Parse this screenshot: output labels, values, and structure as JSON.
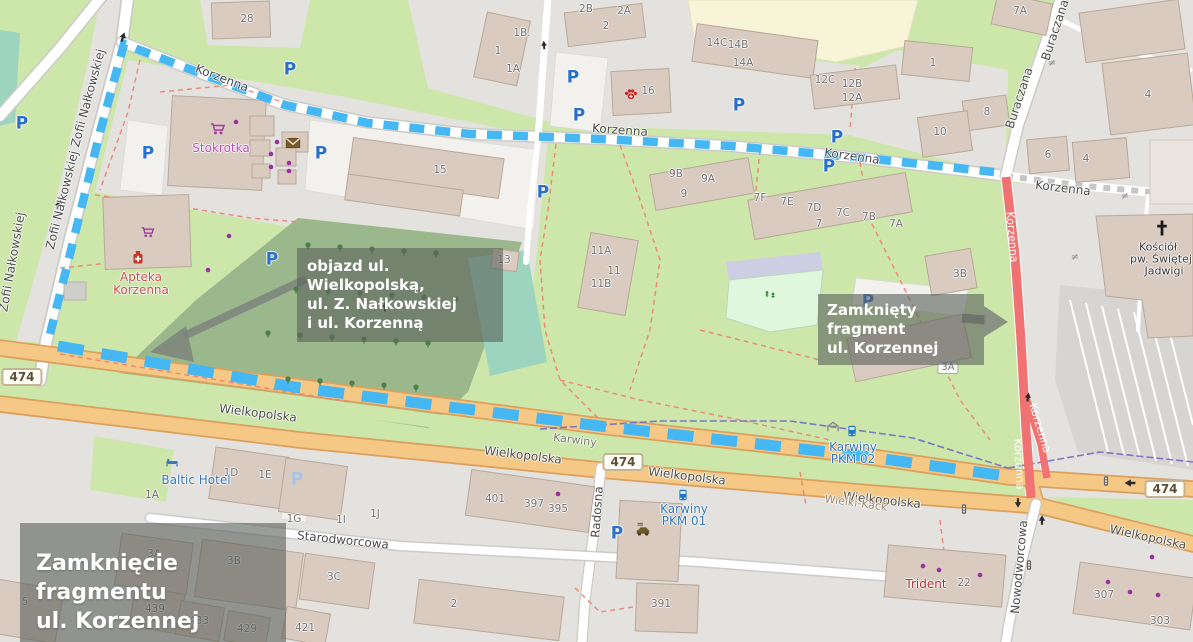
{
  "map": {
    "overlays": {
      "title": {
        "line1": "Zamknięcie fragmentu",
        "line2": "ul. Korzennej"
      },
      "detour_note": {
        "line1": "objazd ul. Wielkopolską,",
        "line2": "ul. Z. Nałkowskiej",
        "line3": "i ul. Korzenną"
      },
      "closure_note": {
        "line1": "Zamknięty fragment",
        "line2": "ul. Korzennej"
      }
    },
    "colors": {
      "route_blue": "#45b7f2",
      "closure_red": "#f17272",
      "road_orange": "#f6c885",
      "road_orange_casing": "#dba05c",
      "green": "#cde7ab",
      "residential_gray": "#e4e2df",
      "cemetery_green": "#9ab88c",
      "teal_pitch": "#9dd4bf",
      "school_yellow": "#f7f4d8",
      "building_fill": "#d9cbc0",
      "building_stroke": "#b9a896",
      "boundary_purple": "#6f63c8",
      "path_red": "#ee8273",
      "note_box_bg": "rgba(92,99,92,0.62)"
    },
    "label_groups": [
      {
        "name": "street-label",
        "cls": "lbl-street halo",
        "items": [
          {
            "t": "Zofii Nałkowskiej",
            "x": 88,
            "y": 98,
            "r": -75
          },
          {
            "t": "Zofii Nałkowskiej",
            "x": 62,
            "y": 200,
            "r": -76
          },
          {
            "t": "Zofii Nałkowskiej",
            "x": 12,
            "y": 262,
            "r": -80
          },
          {
            "t": "Korzenna",
            "x": 222,
            "y": 78,
            "r": 21
          },
          {
            "t": "Korzenna",
            "x": 620,
            "y": 130,
            "r": 4
          },
          {
            "t": "Korzenna",
            "x": 852,
            "y": 156,
            "r": 8
          },
          {
            "t": "Korzenna",
            "x": 1063,
            "y": 188,
            "r": 7
          },
          {
            "t": "Buraczana",
            "x": 1055,
            "y": 30,
            "r": -72
          },
          {
            "t": "Buraczana",
            "x": 1019,
            "y": 98,
            "r": -72
          },
          {
            "t": "Wielkopolska",
            "x": 258,
            "y": 413,
            "r": 7
          },
          {
            "t": "Wielkopolska",
            "x": 523,
            "y": 455,
            "r": 7
          },
          {
            "t": "Wielkopolska",
            "x": 687,
            "y": 476,
            "r": 7
          },
          {
            "t": "Wielkopolska",
            "x": 882,
            "y": 500,
            "r": 6
          },
          {
            "t": "Wielkopolska",
            "x": 1148,
            "y": 537,
            "r": 12
          },
          {
            "t": "Starodworcowa",
            "x": 343,
            "y": 540,
            "r": 6
          },
          {
            "t": "Radosna",
            "x": 597,
            "y": 512,
            "r": -86
          },
          {
            "t": "Nowodworcowa",
            "x": 1019,
            "y": 567,
            "r": -85
          }
        ]
      },
      {
        "name": "street-label-closed-road",
        "cls": "lbl-onred",
        "items": [
          {
            "t": "Korzenna",
            "x": 1012,
            "y": 237,
            "r": 85
          },
          {
            "t": "Korzenna",
            "x": 1040,
            "y": 428,
            "r": 73
          },
          {
            "t": "Korzenna",
            "x": 1019,
            "y": 464,
            "r": 87
          }
        ]
      },
      {
        "name": "district-label",
        "cls": "lbl-district halo",
        "items": [
          {
            "t": "Karwiny",
            "x": 575,
            "y": 440,
            "r": 7
          }
        ]
      },
      {
        "name": "locality-label",
        "cls": "lbl-hamlet halo",
        "items": [
          {
            "t": "Wielki-Kack",
            "x": 856,
            "y": 503,
            "r": 8
          }
        ]
      },
      {
        "name": "house-number",
        "cls": "lbl-num halo",
        "items": [
          {
            "t": "28",
            "x": 247,
            "y": 19
          },
          {
            "t": "1B.",
            "x": 522,
            "y": 33
          },
          {
            "t": "1",
            "x": 498,
            "y": 51
          },
          {
            "t": "1A",
            "x": 513,
            "y": 69
          },
          {
            "t": "2B",
            "x": 586,
            "y": 9
          },
          {
            "t": "2A",
            "x": 624,
            "y": 11
          },
          {
            "t": "2",
            "x": 606,
            "y": 26
          },
          {
            "t": "14C",
            "x": 717,
            "y": 43
          },
          {
            "t": "14B",
            "x": 738,
            "y": 45
          },
          {
            "t": "14A",
            "x": 743,
            "y": 63
          },
          {
            "t": "16",
            "x": 648,
            "y": 91
          },
          {
            "t": "12C",
            "x": 825,
            "y": 80
          },
          {
            "t": "12B",
            "x": 852,
            "y": 84
          },
          {
            "t": "12A",
            "x": 852,
            "y": 98
          },
          {
            "t": "1",
            "x": 933,
            "y": 63
          },
          {
            "t": "8",
            "x": 987,
            "y": 112
          },
          {
            "t": "10",
            "x": 940,
            "y": 132
          },
          {
            "t": "7A",
            "x": 1020,
            "y": 11
          },
          {
            "t": "6",
            "x": 1048,
            "y": 155
          },
          {
            "t": "4",
            "x": 1086,
            "y": 159
          },
          {
            "t": "4",
            "x": 1148,
            "y": 95
          },
          {
            "t": "15",
            "x": 440,
            "y": 170
          },
          {
            "t": "9B",
            "x": 676,
            "y": 174
          },
          {
            "t": "9A",
            "x": 708,
            "y": 179
          },
          {
            "t": "9",
            "x": 684,
            "y": 194
          },
          {
            "t": "7F",
            "x": 760,
            "y": 198
          },
          {
            "t": "7E",
            "x": 787,
            "y": 202
          },
          {
            "t": "7D",
            "x": 814,
            "y": 208
          },
          {
            "t": "7C",
            "x": 843,
            "y": 213
          },
          {
            "t": "7B",
            "x": 869,
            "y": 217
          },
          {
            "t": "7A",
            "x": 896,
            "y": 224
          },
          {
            "t": "7",
            "x": 819,
            "y": 224
          },
          {
            "t": "11A",
            "x": 601,
            "y": 251
          },
          {
            "t": "11",
            "x": 614,
            "y": 271
          },
          {
            "t": "11B",
            "x": 601,
            "y": 284
          },
          {
            "t": "13",
            "x": 504,
            "y": 260
          },
          {
            "t": "3B",
            "x": 960,
            "y": 274
          },
          {
            "t": "5",
            "x": 878,
            "y": 350
          },
          {
            "t": "1A",
            "x": 152,
            "y": 495
          },
          {
            "t": "1D",
            "x": 231,
            "y": 473
          },
          {
            "t": "1E",
            "x": 265,
            "y": 475
          },
          {
            "t": "1G",
            "x": 294,
            "y": 519
          },
          {
            "t": "1I",
            "x": 341,
            "y": 520
          },
          {
            "t": "1J",
            "x": 375,
            "y": 514
          },
          {
            "t": "401",
            "x": 495,
            "y": 499
          },
          {
            "t": "397",
            "x": 534,
            "y": 504
          },
          {
            "t": "395",
            "x": 558,
            "y": 509
          },
          {
            "t": "3A",
            "x": 154,
            "y": 554
          },
          {
            "t": "3B",
            "x": 234,
            "y": 561
          },
          {
            "t": "3C",
            "x": 334,
            "y": 577
          },
          {
            "t": "5",
            "x": 25,
            "y": 602
          },
          {
            "t": "439",
            "x": 155,
            "y": 609
          },
          {
            "t": "433",
            "x": 199,
            "y": 621
          },
          {
            "t": "429",
            "x": 247,
            "y": 629
          },
          {
            "t": "421",
            "x": 305,
            "y": 628
          },
          {
            "t": "2",
            "x": 454,
            "y": 604
          },
          {
            "t": "391",
            "x": 661,
            "y": 604
          },
          {
            "t": "22",
            "x": 964,
            "y": 583
          },
          {
            "t": "307",
            "x": 1104,
            "y": 595
          },
          {
            "t": "303",
            "x": 1160,
            "y": 621
          }
        ]
      },
      {
        "name": "poi-label-supermarket",
        "cls": "poi-shop halo",
        "items": [
          {
            "t": "Stokrotka",
            "x": 221,
            "y": 148
          }
        ]
      },
      {
        "name": "poi-label-pharmacy",
        "cls": "poi-red halo",
        "items": [
          {
            "t": "Apteka",
            "x": 141,
            "y": 277
          },
          {
            "t": "Korzenna",
            "x": 141,
            "y": 290
          }
        ]
      },
      {
        "name": "poi-label-hotel",
        "cls": "poi-blue halo",
        "items": [
          {
            "t": "Baltic Hotel",
            "x": 196,
            "y": 480
          }
        ]
      },
      {
        "name": "poi-label-transit-stop",
        "cls": "poi-blue halo",
        "items": [
          {
            "t": "Karwiny",
            "x": 853,
            "y": 447
          },
          {
            "t": "PKM 02",
            "x": 853,
            "y": 459
          },
          {
            "t": "Karwiny",
            "x": 684,
            "y": 509
          },
          {
            "t": "PKM 01",
            "x": 684,
            "y": 521
          }
        ]
      },
      {
        "name": "poi-label-church",
        "cls": "poi-dark halo",
        "items": [
          {
            "t": "Kościół",
            "x": 1158,
            "y": 247
          },
          {
            "t": "pw. Świętej",
            "x": 1161,
            "y": 259
          },
          {
            "t": "Jadwigi",
            "x": 1164,
            "y": 271
          }
        ]
      },
      {
        "name": "poi-label-business",
        "cls": "poi-red2 halo",
        "items": [
          {
            "t": "Trident",
            "x": 926,
            "y": 584
          }
        ]
      },
      {
        "name": "parking-icon",
        "cls": "lbl-p halo",
        "t": "P",
        "items": [
          {
            "x": 22,
            "y": 124
          },
          {
            "x": 148,
            "y": 154
          },
          {
            "x": 290,
            "y": 70
          },
          {
            "x": 321,
            "y": 154
          },
          {
            "x": 272,
            "y": 260
          },
          {
            "x": 573,
            "y": 78
          },
          {
            "x": 579,
            "y": 116
          },
          {
            "x": 543,
            "y": 193
          },
          {
            "x": 739,
            "y": 106
          },
          {
            "x": 837,
            "y": 138
          },
          {
            "x": 829,
            "y": 167
          },
          {
            "x": 868,
            "y": 302
          },
          {
            "x": 617,
            "y": 534
          }
        ]
      },
      {
        "name": "parking-garage-icon",
        "cls": "lbl-p-pale",
        "t": "P",
        "items": [
          {
            "x": 297,
            "y": 480
          }
        ]
      },
      {
        "name": "route-badge",
        "cls": "lbl-badge",
        "t": "474",
        "items": [
          {
            "x": 22,
            "y": 377
          },
          {
            "x": 623,
            "y": 462
          },
          {
            "x": 1165,
            "y": 489
          }
        ]
      },
      {
        "name": "address-badge",
        "cls": "lbl-badge-sm",
        "t": "3A",
        "items": [
          {
            "x": 948,
            "y": 368
          }
        ]
      },
      {
        "name": "steps-marker",
        "cls": "lbl-step",
        "t": "≠",
        "items": [
          {
            "x": 1052,
            "y": 64
          },
          {
            "x": 1125,
            "y": 197
          },
          {
            "x": 1075,
            "y": 258
          }
        ]
      }
    ],
    "svg_icons": [
      {
        "sym": "cart",
        "x": 218,
        "y": 132
      },
      {
        "sym": "cart",
        "x": 148,
        "y": 235,
        "s": 0.9
      },
      {
        "sym": "pharmacy",
        "x": 138,
        "y": 257
      },
      {
        "sym": "mail",
        "x": 293,
        "y": 143,
        "s": 0.85
      },
      {
        "sym": "paw",
        "x": 631,
        "y": 94,
        "s": 0.95
      },
      {
        "sym": "bed",
        "x": 172,
        "y": 463,
        "s": 0.8
      },
      {
        "sym": "bus",
        "x": 683,
        "y": 495,
        "s": 0.8
      },
      {
        "sym": "bus",
        "x": 852,
        "y": 431,
        "s": 0.8
      },
      {
        "sym": "shelter",
        "x": 833,
        "y": 427,
        "s": 0.85
      },
      {
        "sym": "car",
        "x": 643,
        "y": 531,
        "s": 0.9
      },
      {
        "sym": "tlight",
        "x": 1106,
        "y": 481,
        "s": 0.8
      },
      {
        "sym": "tlight",
        "x": 964,
        "y": 509,
        "s": 0.8
      },
      {
        "sym": "tlight",
        "x": 1029,
        "y": 565,
        "s": 0.8
      },
      {
        "sym": "cross",
        "x": 1162,
        "y": 228,
        "s": 1.25
      },
      {
        "sym": "cross",
        "x": 385,
        "y": 307,
        "s": 0.75
      },
      {
        "sym": "playground",
        "x": 770,
        "y": 295
      },
      {
        "sym": "arrow",
        "x": 123,
        "y": 37,
        "r": 18,
        "s": 0.8
      },
      {
        "sym": "arrow",
        "x": 544,
        "y": 45,
        "r": -4,
        "s": 0.7
      },
      {
        "sym": "arrow",
        "x": 58,
        "y": 205,
        "r": 15,
        "s": 0.7
      },
      {
        "sym": "arrow",
        "x": 1042,
        "y": 520,
        "s": 0.8
      },
      {
        "sym": "arrow",
        "x": 1018,
        "y": 503,
        "r": 180,
        "s": 0.8
      },
      {
        "sym": "arrow",
        "x": 1130,
        "y": 483,
        "r": -90,
        "s": 0.9
      },
      {
        "sym": "arrow",
        "x": 1028,
        "y": 397,
        "r": 8,
        "s": 0.75
      },
      {
        "sym": "bush",
        "x": 308,
        "y": 246
      },
      {
        "sym": "bush",
        "x": 340,
        "y": 248
      },
      {
        "sym": "bush",
        "x": 372,
        "y": 250
      },
      {
        "sym": "bush",
        "x": 404,
        "y": 252
      },
      {
        "sym": "bush",
        "x": 436,
        "y": 254
      },
      {
        "sym": "bush",
        "x": 296,
        "y": 290
      },
      {
        "sym": "bush",
        "x": 328,
        "y": 292
      },
      {
        "sym": "bush",
        "x": 360,
        "y": 294
      },
      {
        "sym": "bush",
        "x": 392,
        "y": 296
      },
      {
        "sym": "bush",
        "x": 424,
        "y": 298
      },
      {
        "sym": "bush",
        "x": 456,
        "y": 300
      },
      {
        "sym": "bush",
        "x": 268,
        "y": 334
      },
      {
        "sym": "bush",
        "x": 300,
        "y": 336
      },
      {
        "sym": "bush",
        "x": 332,
        "y": 338
      },
      {
        "sym": "bush",
        "x": 364,
        "y": 340
      },
      {
        "sym": "bush",
        "x": 396,
        "y": 342
      },
      {
        "sym": "bush",
        "x": 428,
        "y": 344
      },
      {
        "sym": "bush",
        "x": 288,
        "y": 380
      },
      {
        "sym": "bush",
        "x": 320,
        "y": 382
      },
      {
        "sym": "bush",
        "x": 352,
        "y": 384
      },
      {
        "sym": "bush",
        "x": 384,
        "y": 386
      },
      {
        "sym": "bush",
        "x": 416,
        "y": 388
      },
      {
        "sym": "dot",
        "x": 236,
        "y": 122
      },
      {
        "sym": "dot",
        "x": 277,
        "y": 142
      },
      {
        "sym": "dot",
        "x": 271,
        "y": 154
      },
      {
        "sym": "dot",
        "x": 289,
        "y": 163
      },
      {
        "sym": "dot",
        "x": 271,
        "y": 167
      },
      {
        "sym": "dot",
        "x": 289,
        "y": 171
      },
      {
        "sym": "dot",
        "x": 229,
        "y": 236
      },
      {
        "sym": "dot",
        "x": 208,
        "y": 270
      },
      {
        "sym": "dot",
        "x": 558,
        "y": 494
      },
      {
        "sym": "dot",
        "x": 939,
        "y": 570
      },
      {
        "sym": "dot",
        "x": 980,
        "y": 575
      },
      {
        "sym": "dot",
        "x": 1108,
        "y": 582
      },
      {
        "sym": "dot",
        "x": 1158,
        "y": 595
      },
      {
        "sym": "dot",
        "x": 923,
        "y": 566,
        "col": "#c41f1f"
      },
      {
        "sym": "dot",
        "x": 1152,
        "y": 557,
        "col": "#b8860b"
      },
      {
        "sym": "dot",
        "x": 1130,
        "y": 592,
        "col": "#b8860b"
      }
    ]
  }
}
